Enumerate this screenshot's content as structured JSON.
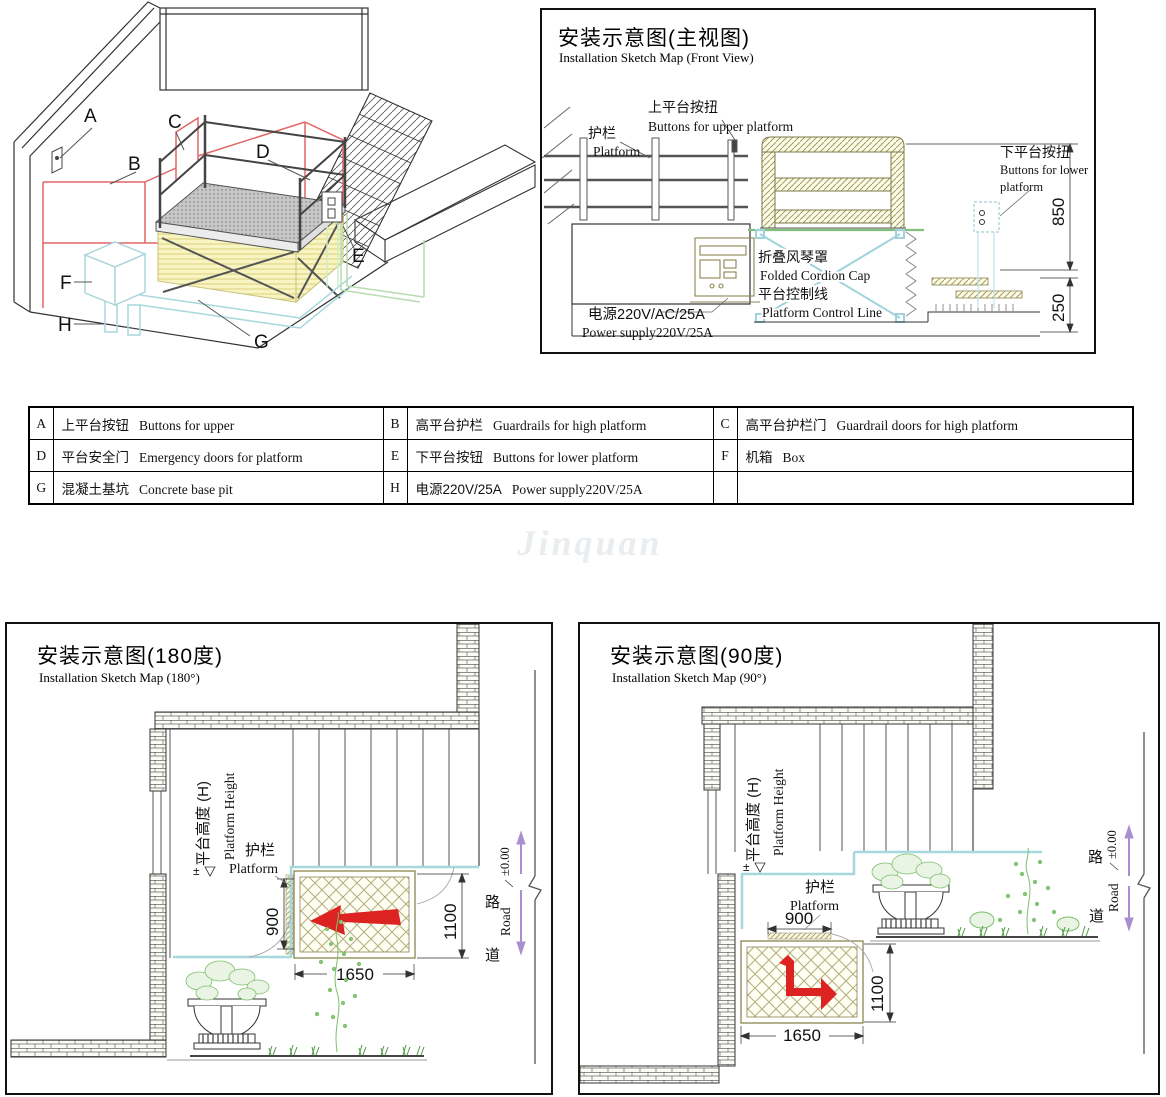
{
  "watermark": "Jinquan",
  "iso": {
    "label_a": "A",
    "label_b": "B",
    "label_c": "C",
    "label_d": "D",
    "label_e": "E",
    "label_f": "F",
    "label_g": "G",
    "label_h": "H"
  },
  "front": {
    "title_zh": "安装示意图(主视图)",
    "title_en": "Installation Sketch Map (Front View)",
    "guardrail_zh": "护栏",
    "guardrail_en": "Platform",
    "upper_btn_zh": "上平台按扭",
    "upper_btn_en": "Buttons for upper platform",
    "lower_btn_zh": "下平台按扭",
    "lower_btn_en1": "Buttons for lower",
    "lower_btn_en2": "platform",
    "cap_zh": "折叠风琴罩",
    "cap_en": "Folded Cordion Cap",
    "ctrl_zh": "平台控制线",
    "ctrl_en": "Platform Control Line",
    "power_zh": "电源220V/AC/25A",
    "power_en": "Power supply220V/25A",
    "dim_850": "850",
    "dim_250": "250"
  },
  "legend": {
    "rows": [
      [
        {
          "key": "A",
          "zh": "上平台按钮",
          "en": "Buttons for upper"
        },
        {
          "key": "B",
          "zh": "高平台护栏",
          "en": "Guardrails for high platform"
        },
        {
          "key": "C",
          "zh": "高平台护栏门",
          "en": "Guardrail doors for high platform"
        }
      ],
      [
        {
          "key": "D",
          "zh": "平台安全门",
          "en": "Emergency doors for platform"
        },
        {
          "key": "E",
          "zh": "下平台按钮",
          "en": "Buttons for lower platform"
        },
        {
          "key": "F",
          "zh": "机箱",
          "en": "Box"
        }
      ],
      [
        {
          "key": "G",
          "zh": "混凝土基坑",
          "en": "Concrete base pit"
        },
        {
          "key": "H",
          "zh": "电源220V/25A",
          "en": "Power supply220V/25A"
        },
        {
          "key": "",
          "zh": "",
          "en": ""
        }
      ]
    ]
  },
  "plan180": {
    "title_zh": "安装示意图(180度)",
    "title_en": "Installation Sketch Map (180°)",
    "ph_zh": "平台高度 (H)",
    "ph_en": "Platform Height",
    "pm": "±",
    "guardrail_zh": "护栏",
    "guardrail_en": "Platform",
    "dim_900": "900",
    "dim_1100": "1100",
    "dim_1650": "1650",
    "level": "±0.00",
    "road_zh_top": "路",
    "road_zh_bottom": "道",
    "road_en": "Road"
  },
  "plan90": {
    "title_zh": "安装示意图(90度)",
    "title_en": "Installation Sketch Map (90°)",
    "ph_zh": "平台高度 (H)",
    "ph_en": "Platform Height",
    "pm": "±",
    "guardrail_zh": "护栏",
    "guardrail_en": "Platform",
    "dim_900": "900",
    "dim_1100": "1100",
    "dim_1650": "1650",
    "level": "±0.00",
    "road_zh_top": "路",
    "road_zh_bottom": "道",
    "road_en": "Road"
  }
}
